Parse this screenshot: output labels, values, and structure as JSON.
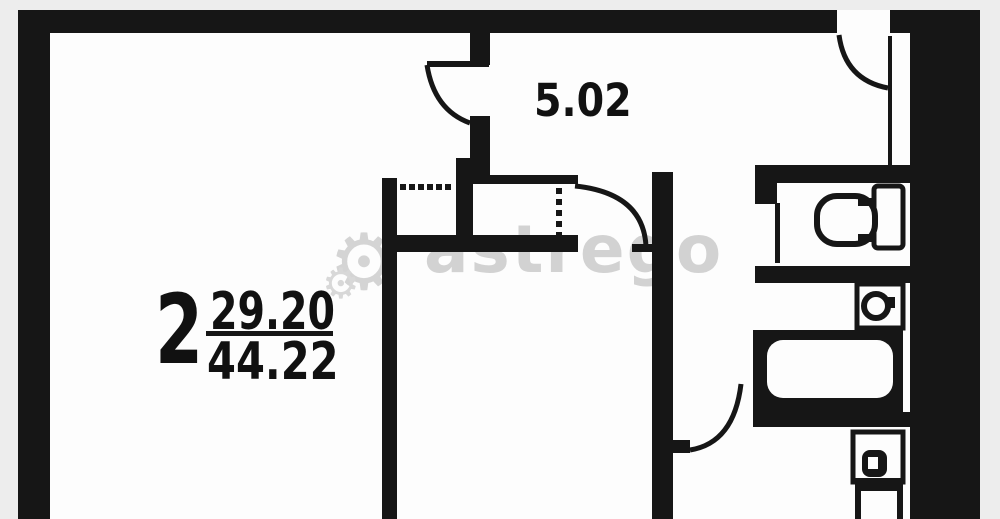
{
  "plan": {
    "hallway_area_label": "5.02",
    "rooms_count": "2",
    "living_area": "29.20",
    "total_area": "44.22"
  },
  "watermark": {
    "text": "astrego",
    "gear_icon": "⚙",
    "gear_icon_small": "⚙"
  },
  "colors": {
    "wall": "#161616",
    "paper": "#fdfdfd",
    "margin": "#ededed",
    "watermark": "#d2d2d2"
  },
  "fixtures": {
    "toilet": "toilet-icon",
    "sink": "sink-icon",
    "bathtub": "bathtub-icon",
    "stove": "stove-icon"
  }
}
